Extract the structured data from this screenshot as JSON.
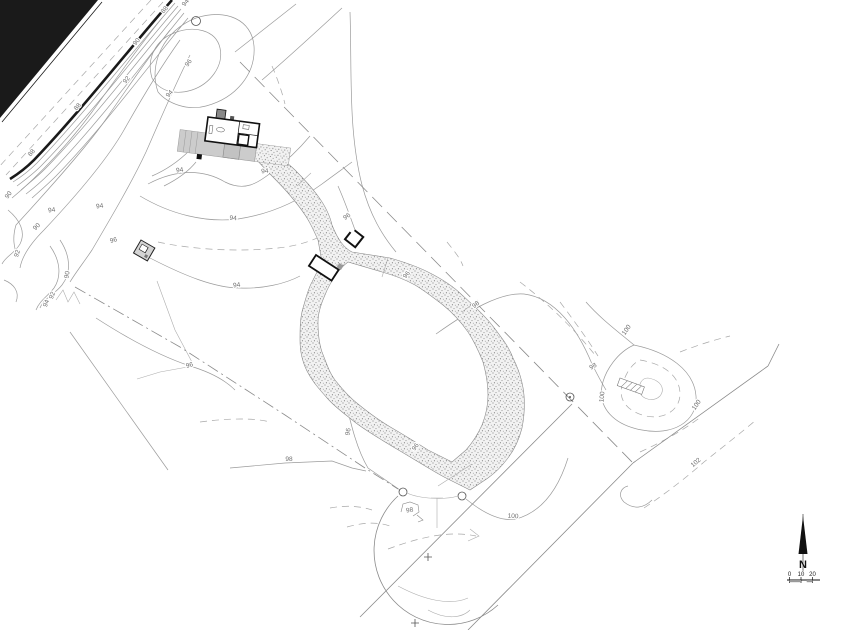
{
  "plan": {
    "kind": "topographic site plan",
    "north": {
      "label": "N"
    },
    "scale_bar": {
      "ticks": [
        "0",
        "10",
        "20"
      ]
    },
    "spot_elevation": {
      "text": "98"
    },
    "contour_labels": [
      {
        "t": "94",
        "x": 187,
        "y": 4,
        "r": -50
      },
      {
        "t": "88",
        "x": 166,
        "y": 11,
        "r": -50
      },
      {
        "t": "90",
        "x": 138,
        "y": 43,
        "r": -50
      },
      {
        "t": "96",
        "x": 190,
        "y": 64,
        "r": -55
      },
      {
        "t": "92",
        "x": 128,
        "y": 81,
        "r": -52
      },
      {
        "t": "94",
        "x": 171,
        "y": 95,
        "r": -50
      },
      {
        "t": "88",
        "x": 79,
        "y": 108,
        "r": -50
      },
      {
        "t": "88",
        "x": 33,
        "y": 154,
        "r": -50
      },
      {
        "t": "90",
        "x": 10,
        "y": 196,
        "r": -55
      },
      {
        "t": "94",
        "x": 52,
        "y": 212,
        "r": -8
      },
      {
        "t": "94",
        "x": 100,
        "y": 208,
        "r": -8
      },
      {
        "t": "90",
        "x": 38,
        "y": 228,
        "r": -45
      },
      {
        "t": "96",
        "x": 114,
        "y": 242,
        "r": -15
      },
      {
        "t": "92",
        "x": 19,
        "y": 254,
        "r": -72
      },
      {
        "t": "90",
        "x": 69,
        "y": 275,
        "r": -80
      },
      {
        "t": "92",
        "x": 54,
        "y": 296,
        "r": -70
      },
      {
        "t": "94",
        "x": 48,
        "y": 304,
        "r": -70
      },
      {
        "t": "94",
        "x": 180,
        "y": 172,
        "r": -8
      },
      {
        "t": "94",
        "x": 265,
        "y": 173,
        "r": -5
      },
      {
        "t": "94",
        "x": 233,
        "y": 220,
        "r": 4
      },
      {
        "t": "94",
        "x": 237,
        "y": 287,
        "r": -8
      },
      {
        "t": "96",
        "x": 348,
        "y": 218,
        "r": -35
      },
      {
        "t": "96",
        "x": 408,
        "y": 276,
        "r": -50
      },
      {
        "t": "96",
        "x": 190,
        "y": 367,
        "r": -15
      },
      {
        "t": "96",
        "x": 350,
        "y": 432,
        "r": -80
      },
      {
        "t": "96",
        "x": 417,
        "y": 448,
        "r": -55
      },
      {
        "t": "98",
        "x": 289,
        "y": 461,
        "r": 0
      },
      {
        "t": "98",
        "x": 477,
        "y": 306,
        "r": -40
      },
      {
        "t": "98",
        "x": 594,
        "y": 368,
        "r": -30
      },
      {
        "t": "100",
        "x": 628,
        "y": 331,
        "r": -55
      },
      {
        "t": "100",
        "x": 604,
        "y": 397,
        "r": -85
      },
      {
        "t": "100",
        "x": 698,
        "y": 406,
        "r": -55
      },
      {
        "t": "100",
        "x": 513,
        "y": 518,
        "r": 3
      },
      {
        "t": "102",
        "x": 697,
        "y": 464,
        "r": -40
      }
    ],
    "colors": {
      "paper": "#ffffff",
      "ink": "#1a1a1a",
      "contour": "#9b9b9b",
      "terrace_gray": "#cccccc",
      "stipple_dot": "#666666"
    }
  }
}
